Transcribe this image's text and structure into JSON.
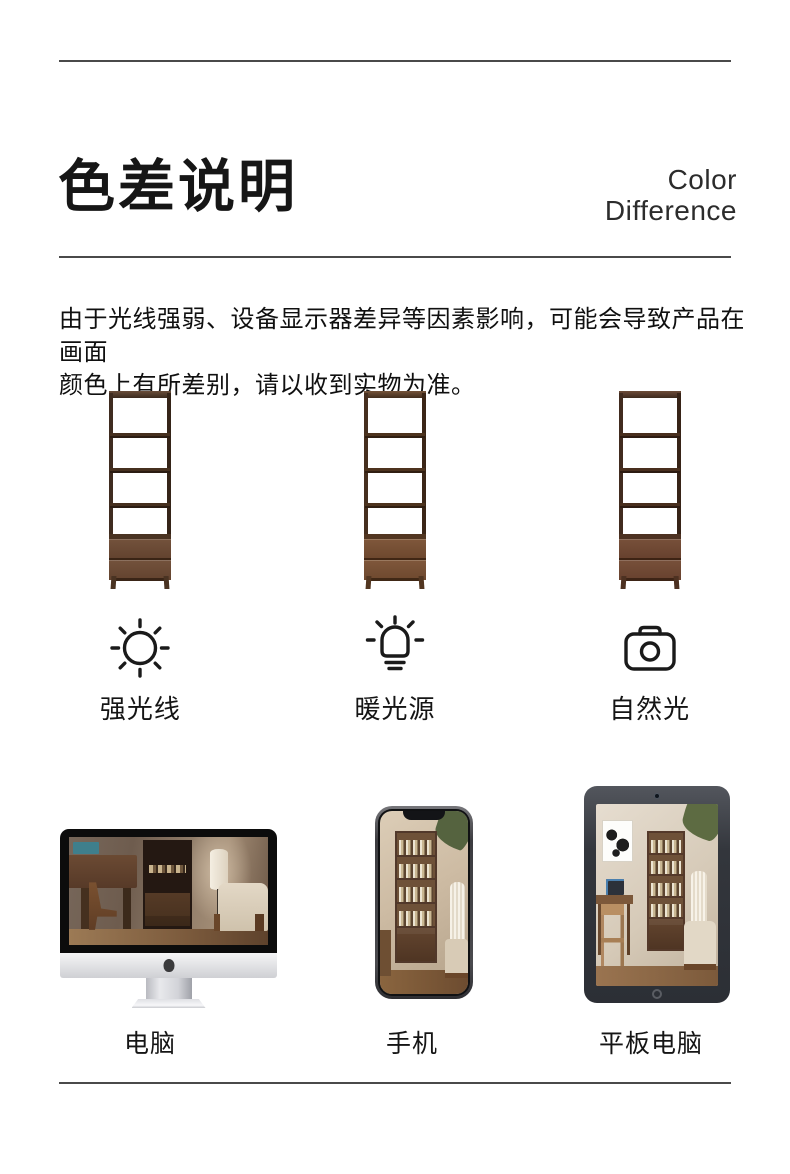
{
  "theme": {
    "page-bg": "#ffffff",
    "divider": "#4a4a4a",
    "ink": "#161616",
    "body": "#101010",
    "label": "#151515",
    "icon": "#1a1a1a",
    "wood-frame": "#3f2c20",
    "wood-board": "#46301f",
    "wood-top-light": "#6a4e3a",
    "drawer-light": "#73523c",
    "drawer-dark": "#63432f"
  },
  "header": {
    "title": "色差说明",
    "subtitle_line1": "Color",
    "subtitle_line2": "Difference"
  },
  "notice": {
    "line1": "由于光线强弱、设备显示器差异等因素影响，可能会导致产品在画面",
    "line2": "颜色上有所差别，请以收到实物为准。"
  },
  "lighting": {
    "items": [
      {
        "icon": "sun-icon",
        "label": "强光线"
      },
      {
        "icon": "bulb-icon",
        "label": "暖光源"
      },
      {
        "icon": "camera-icon",
        "label": "自然光"
      }
    ]
  },
  "devices": {
    "items": [
      {
        "icon": "computer-mockup",
        "label": "电脑"
      },
      {
        "icon": "phone-mockup",
        "label": "手机"
      },
      {
        "icon": "tablet-mockup",
        "label": "平板电脑"
      }
    ]
  }
}
